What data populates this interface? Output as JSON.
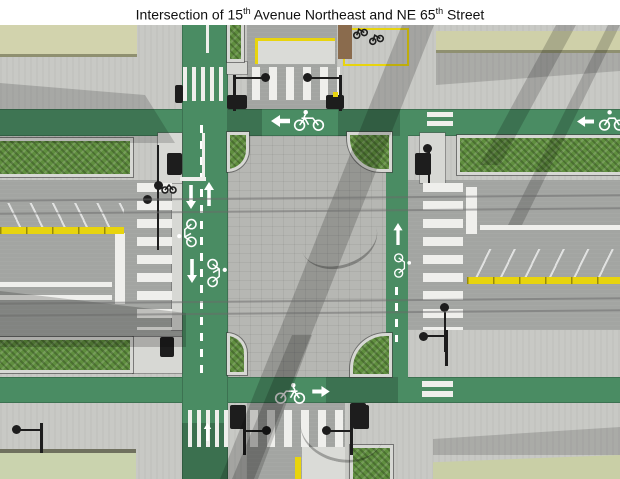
{
  "title": {
    "part1": "Intersection of 15",
    "sup1": "th",
    "part2": " Avenue Northeast and NE 65",
    "sup2": "th",
    "part3": " Street"
  },
  "colors": {
    "sidewalk": "#c8c9c5",
    "asphalt": "#a3a5a2",
    "paver": "#b6b7b3",
    "concrete": "#d7d8d4",
    "green-paint": "#4a8c63",
    "green-dark": "#2f6a4a",
    "hedge": "#5f8e3e",
    "marking-white": "#efefec",
    "marking-yellow": "#e8d40e",
    "building-1": "#d2d3ad",
    "building-2": "#cfd0a9",
    "building-3": "#cad3ae",
    "building-4": "#c9cfa6",
    "building-edge": "#8f9070",
    "pole-black": "#1d1d1d",
    "brown-bed": "#8a6b4d",
    "title-text": "#111111"
  },
  "icons": {
    "bike_marking": "bicycle-with-rider pavement symbol",
    "arrow_left": "left turn/through arrow",
    "arrow_right": "right through arrow",
    "arrow_up": "northbound arrow",
    "arrow_down": "southbound arrow",
    "street_lamp": "teardrop luminaire head",
    "traffic_signal": "signal head box",
    "parked_bike": "bicycle at rack"
  }
}
